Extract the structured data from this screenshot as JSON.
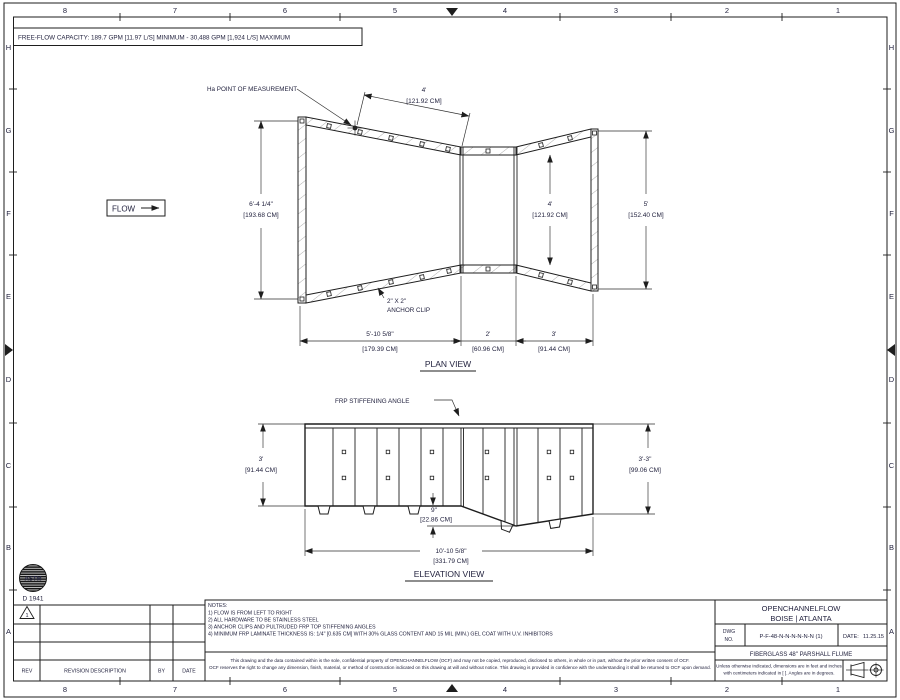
{
  "drawing": {
    "free_flow_capacity": "FREE-FLOW CAPACITY:  189.7 GPM [11.97 L/S] MINIMUM - 30,488 GPM [1,924 L/S] MAXIMUM"
  },
  "border": {
    "columns": [
      "8",
      "7",
      "6",
      "5",
      "4",
      "3",
      "2",
      "1"
    ],
    "rows": [
      "H",
      "G",
      "F",
      "E",
      "D",
      "C",
      "B",
      "A"
    ]
  },
  "plan": {
    "title": "PLAN VIEW",
    "flow_label": "FLOW",
    "ha_label": "Ha POINT OF MEASUREMENT",
    "anchor_clip_label_1": "2\" X 2\"",
    "anchor_clip_label_2": "ANCHOR CLIP",
    "dims": {
      "inlet_width_ft": "6'-4 1/4\"",
      "inlet_width_cm": "[193.68 CM]",
      "ha_throat_ft": "4'",
      "ha_throat_cm": "[121.92 CM]",
      "throat_width_ft": "4'",
      "throat_width_cm": "[121.92 CM]",
      "outlet_width_ft": "5'",
      "outlet_width_cm": "[152.40 CM]",
      "converging_ft": "5'-10 5/8\"",
      "converging_cm": "[179.39 CM]",
      "throat_len_ft": "2'",
      "throat_len_cm": "[60.96 CM]",
      "diverging_ft": "3'",
      "diverging_cm": "[91.44 CM]"
    }
  },
  "elevation": {
    "title": "ELEVATION VIEW",
    "frp_label": "FRP STIFFENING ANGLE",
    "dims": {
      "left_h_ft": "3'",
      "left_h_cm": "[91.44 CM]",
      "right_h_ft": "3'-3\"",
      "right_h_cm": "[99.06 CM]",
      "drop_ft": "9\"",
      "drop_cm": "[22.86 CM]",
      "total_ft": "10'-10 5/8\"",
      "total_cm": "[331.79 CM]"
    }
  },
  "notes": {
    "title": "NOTES:",
    "items": [
      "1)  FLOW IS FROM LEFT TO RIGHT",
      "2)  ALL HARDWARE TO BE STAINLESS STEEL",
      "3)  ANCHOR CLIPS AND PULTRUDED FRP TOP STIFFENING ANGLES",
      "4)  MINIMUM FRP LAMINATE THICKNESS IS:  1/4\" [0.635 CM]  WITH 30% GLASS CONTENT AND 15 MIL (MIN.) GEL COAT WITH U.V. INHIBITORS"
    ]
  },
  "astm": {
    "logo": "ASTM",
    "standard": "D 1941"
  },
  "revisions": {
    "marker": "1",
    "headers": [
      "REV",
      "REVISION DESCRIPTION",
      "BY",
      "DATE"
    ]
  },
  "legal": {
    "line1": "This drawing and the data contained within is the sole, confidential property of OPENCHANNELFLOW (OCF) and may not be copied, reproduced, disclosed to others, in whole or in part, without the prior written consent of OCF.",
    "line2": "OCF reserves the right to change any dimension, finish, material, or method of construction indicated on this drawing at will and without notice.  This drawing is provided in confidence with the understanding it shall be returned to OCF upon demand."
  },
  "title_block": {
    "company_line1": "OPENCHANNELFLOW",
    "company_line2": "BOISE | ATLANTA",
    "dwg_label_1": "DWG",
    "dwg_label_2": "NO.",
    "dwg_no": "P-F-48-N-N-N-N-N-N (1)",
    "date_label": "DATE:",
    "date_value": "11.25.15",
    "description": "FIBERGLASS 48\" PARSHALL FLUME",
    "units_line1": "Unless otherwise indicated, dimensions are in feet and inches",
    "units_line2": "with centimeters indicated in [ ].  Angles are in degrees."
  }
}
